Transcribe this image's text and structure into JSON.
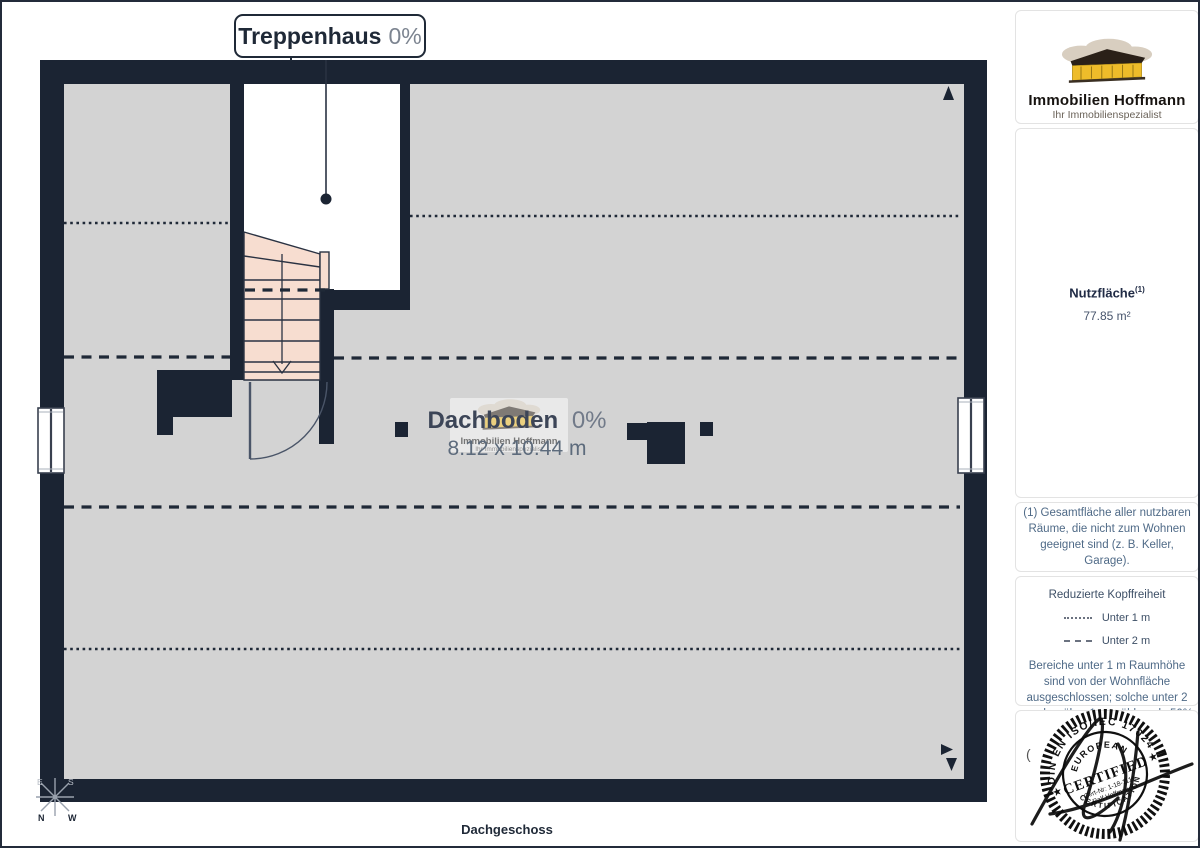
{
  "page": {
    "footer_label": "Dachgeschoss",
    "colors": {
      "wall": "#1b2433",
      "floor": "#d3d3d3",
      "stairs": "#f7ddd0",
      "line": "#1f2937",
      "logo_yellow": "#eebc2a"
    }
  },
  "plan": {
    "room_label": {
      "name": "Treppenhaus",
      "percent": "0%"
    },
    "area_label": {
      "name": "Dachboden",
      "percent": "0%",
      "dimensions": "8.12 x 10.44 m"
    },
    "compass": {
      "n": "N",
      "s": "S",
      "e": "E",
      "w": "W"
    }
  },
  "sidebar": {
    "logo": {
      "company": "Immobilien Hoffmann",
      "tagline": "Ihr Immobilienspezialist"
    },
    "watermark": {
      "company": "Immobilien Hoffmann",
      "tagline": "Ihr Immobilienspezialist"
    },
    "area": {
      "label": "Nutzfläche",
      "superscript": "(1)",
      "value": "77.85 m²"
    },
    "footnote": "(1) Gesamtfläche aller nutzbaren Räume, die nicht zum Wohnen geeignet sind (z. B. Keller, Garage).",
    "legend": {
      "title": "Reduzierte Kopffreiheit",
      "items": [
        {
          "style": "dotted",
          "label": "Unter 1 m"
        },
        {
          "style": "dashed",
          "label": "Unter 2 m"
        }
      ],
      "note": "Bereiche unter 1 m Raumhöhe sind von der Wohnfläche ausgeschlossen; solche unter 2 m, aber über 1 m, zählen als 50% der Wohnfläche"
    },
    "stamp": {
      "arc_top": "DIN EN ISO/IEC 17024",
      "arc_inner_top": "EUROPEAN",
      "center": "CERTIFIED",
      "cert_no": "Cert-Nr: 1-18-1115",
      "name": "Ralf Hoffmann",
      "arc_bottom": "CERTIFICATION",
      "star": "★"
    },
    "stray_char": "("
  }
}
